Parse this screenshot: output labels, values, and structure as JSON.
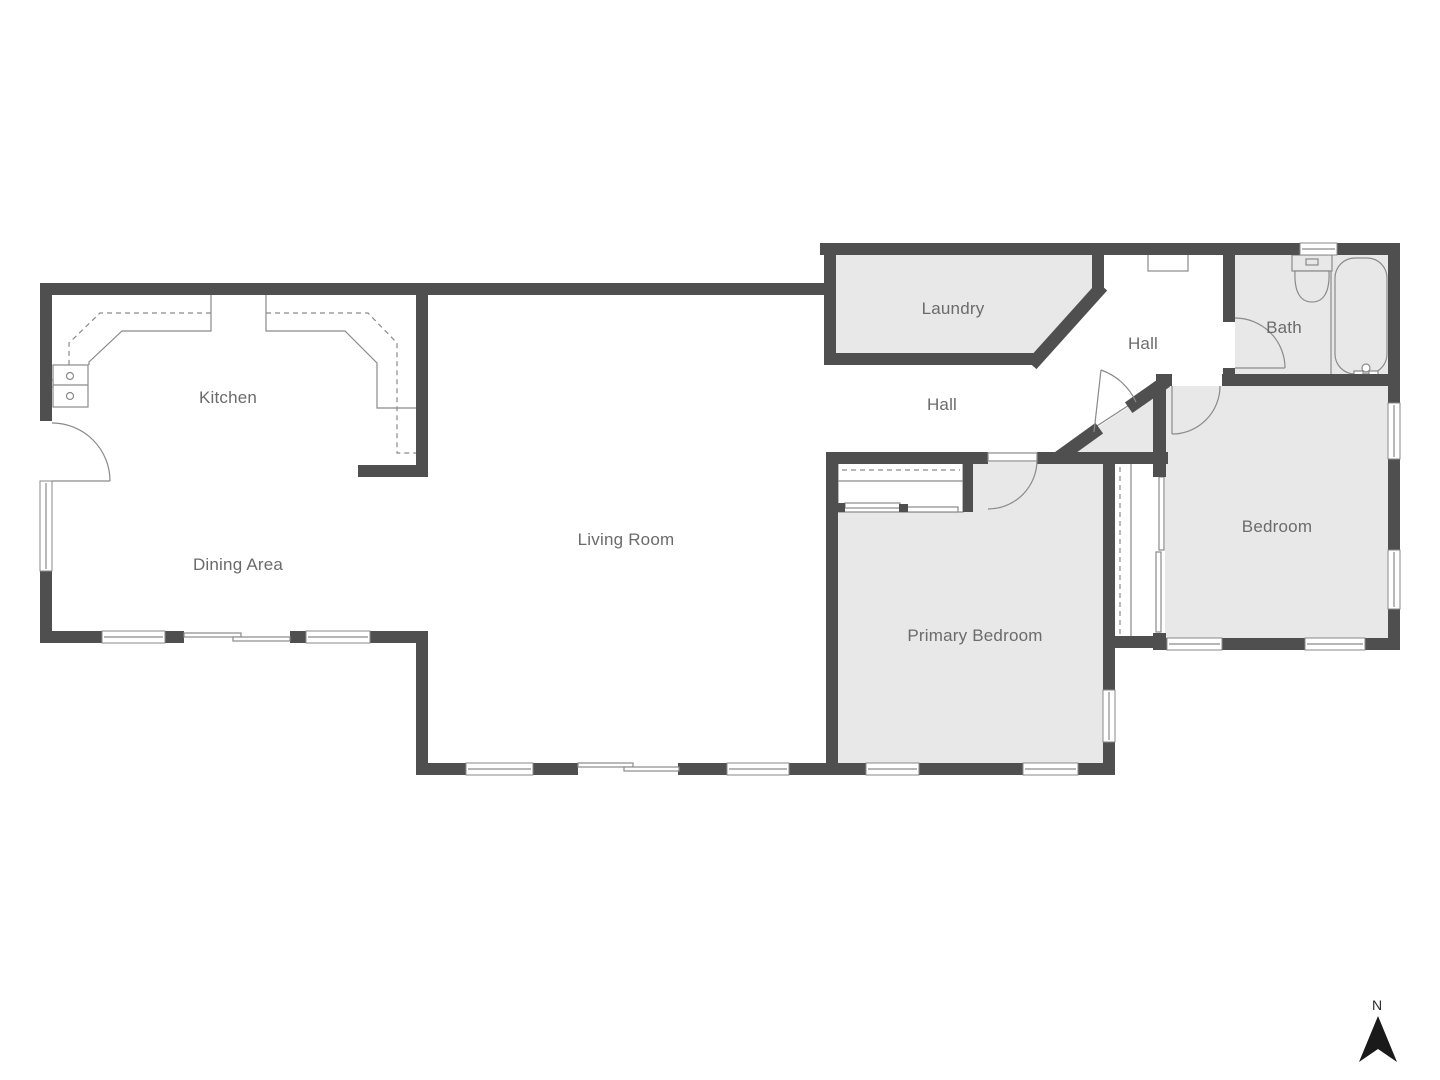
{
  "colors": {
    "wall": "#4f4f4f",
    "fill": "#e8e8e8",
    "line": "#8a8a8a",
    "label": "#6b6b6b",
    "north": "#1a1a1a"
  },
  "rooms": {
    "kitchen": {
      "label": "Kitchen"
    },
    "dining": {
      "label": "Dining Area"
    },
    "living": {
      "label": "Living Room"
    },
    "hall_lower": {
      "label": "Hall"
    },
    "laundry": {
      "label": "Laundry"
    },
    "hall_upper": {
      "label": "Hall"
    },
    "bath": {
      "label": "Bath"
    },
    "bedroom": {
      "label": "Bedroom"
    },
    "primary_bedroom": {
      "label": "Primary Bedroom"
    }
  },
  "compass": {
    "label": "N"
  }
}
